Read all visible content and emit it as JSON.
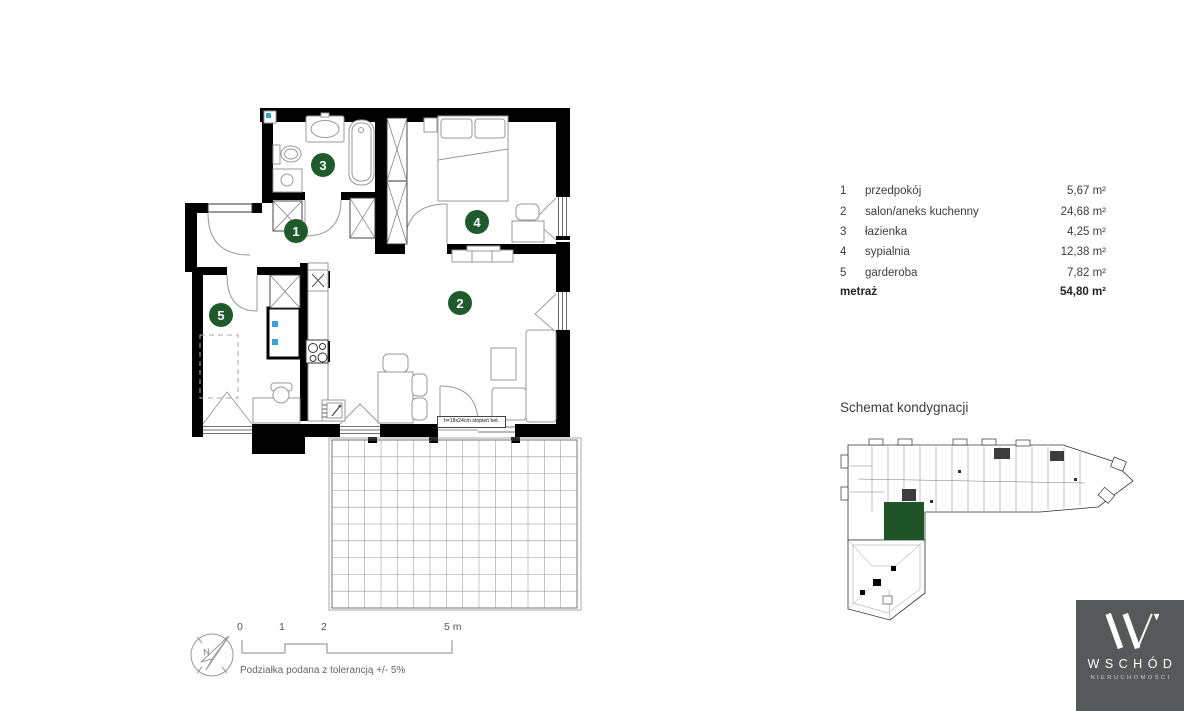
{
  "legend": {
    "rows": [
      {
        "num": "1",
        "name": "przedpokój",
        "area": "5,67 m²"
      },
      {
        "num": "2",
        "name": "salon/aneks kuchenny",
        "area": "24,68 m²"
      },
      {
        "num": "3",
        "name": "łazienka",
        "area": "4,25 m²"
      },
      {
        "num": "4",
        "name": "sypialnia",
        "area": "12,38 m²"
      },
      {
        "num": "5",
        "name": "garderoba",
        "area": "7,82 m²"
      }
    ],
    "total_label": "metraż",
    "total_value": "54,80 m²"
  },
  "plan": {
    "step_note": "h=18x24cm stopień bet.",
    "wall_color": "#000000",
    "furniture_color": "#999999",
    "marker_color": "#1e5a2b"
  },
  "schematic": {
    "title": "Schemat kondygnacji",
    "unit_color": "#1e5427"
  },
  "scalebar": {
    "tick_labels": [
      "0",
      "1",
      "2",
      "5 m"
    ],
    "tolerance_note": "Podziałka podana z tolerancją +/- 5%"
  },
  "compass": {
    "north_label": "N"
  },
  "logo": {
    "brand": "WSCHÓD",
    "tagline": "NIERUCHOMOŚCI",
    "bg_color": "#57585a"
  }
}
